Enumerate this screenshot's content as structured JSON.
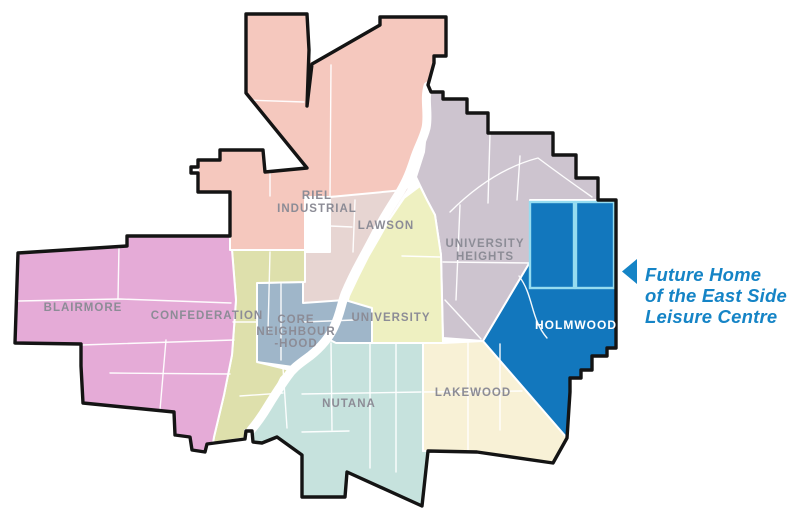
{
  "map": {
    "regions": {
      "riel_industrial": {
        "label_line1": "RIEL",
        "label_line2": "INDUSTRIAL",
        "color": "#F5C8BE"
      },
      "lawson": {
        "label": "LAWSON",
        "color": "#E7D5D2"
      },
      "university_heights": {
        "label_line1": "UNIVERSITY",
        "label_line2": "HEIGHTS",
        "color": "#CDC4CF"
      },
      "blairmore": {
        "label": "BLAIRMORE",
        "color": "#E5ABD7"
      },
      "confederation": {
        "label": "CONFEDERATION",
        "color": "#DEE0AC"
      },
      "core_neighbourhood": {
        "label_line1": "CORE",
        "label_line2": "NEIGHBOUR",
        "label_line3": "-HOOD",
        "color": "#9FB6C9"
      },
      "university": {
        "label": "UNIVERSITY",
        "color": "#EEF0C1"
      },
      "nutana": {
        "label": "NUTANA",
        "color": "#C6E2DD"
      },
      "lakewood": {
        "label": "LAKEWOOD",
        "color": "#F8F1D6"
      },
      "holmwood": {
        "label": "HOLMWOOD",
        "color": "#1277BD",
        "label_color": "#FFFFFF",
        "parcel_line_color": "#96DCF0"
      }
    },
    "label_color": "#8C8C96",
    "outline_color": "#141414",
    "river_color": "#FFFFFF",
    "annotation": {
      "line1": "Future Home",
      "line2": "of the East Side",
      "line3": "Leisure Centre",
      "color": "#1584C6"
    }
  }
}
